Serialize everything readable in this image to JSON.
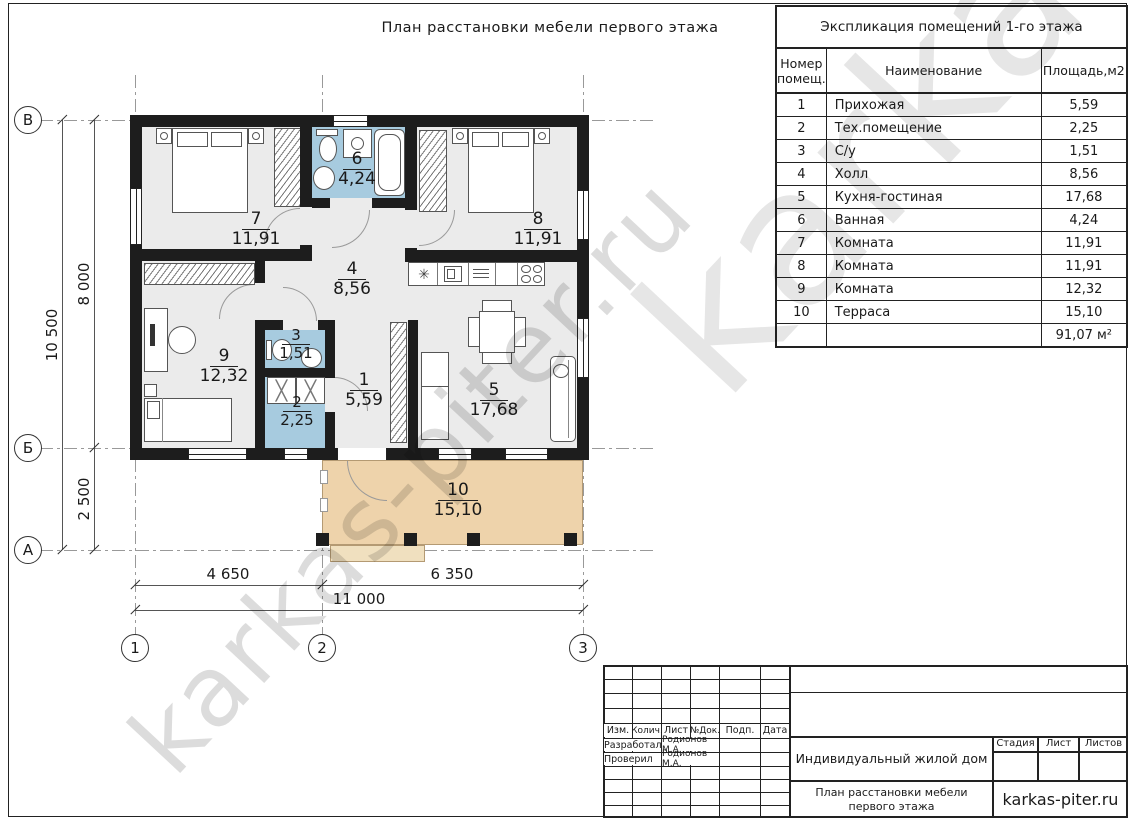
{
  "sheet": {
    "title": "План расстановки мебели первого этажа"
  },
  "watermark": {
    "text": "karkas-piter.ru"
  },
  "icons": {
    "counter_sink": "✳",
    "equipment_cross": "╳"
  },
  "colors": {
    "wall": "#1d1d1d",
    "room_fill": "#ebebeb",
    "wet_room_fill": "#a7cbdf",
    "terrace_fill": "#eed3ab"
  },
  "schedule": {
    "title": "Экспликация помещений 1-го этажа",
    "col_num": "Номер помещ.",
    "col_name": "Наименование",
    "col_area": "Площадь,м2",
    "rows": [
      {
        "num": "1",
        "name": "Прихожая",
        "area": "5,59"
      },
      {
        "num": "2",
        "name": "Тех.помещение",
        "area": "2,25"
      },
      {
        "num": "3",
        "name": "С/у",
        "area": "1,51"
      },
      {
        "num": "4",
        "name": "Холл",
        "area": "8,56"
      },
      {
        "num": "5",
        "name": "Кухня-гостиная",
        "area": "17,68"
      },
      {
        "num": "6",
        "name": "Ванная",
        "area": "4,24"
      },
      {
        "num": "7",
        "name": "Комната",
        "area": "11,91"
      },
      {
        "num": "8",
        "name": "Комната",
        "area": "11,91"
      },
      {
        "num": "9",
        "name": "Комната",
        "area": "12,32"
      },
      {
        "num": "10",
        "name": "Терраса",
        "area": "15,10"
      }
    ],
    "total": "91,07 м²"
  },
  "plan": {
    "rooms": [
      {
        "num": "1",
        "area": "5,59"
      },
      {
        "num": "2",
        "area": "2,25"
      },
      {
        "num": "3",
        "area": "1,51"
      },
      {
        "num": "4",
        "area": "8,56"
      },
      {
        "num": "5",
        "area": "17,68"
      },
      {
        "num": "6",
        "area": "4,24"
      },
      {
        "num": "7",
        "area": "11,91"
      },
      {
        "num": "8",
        "area": "11,91"
      },
      {
        "num": "9",
        "area": "12,32"
      },
      {
        "num": "10",
        "area": "15,10"
      }
    ],
    "axes": {
      "row_top": "В",
      "row_mid": "Б",
      "row_bottom": "А",
      "col_left": "1",
      "col_mid": "2",
      "col_right": "3"
    },
    "dims": {
      "left_total": "10 500",
      "left_upper": "8 000",
      "left_lower": "2 500",
      "bottom_left": "4 650",
      "bottom_right": "6 350",
      "bottom_total": "11 000"
    }
  },
  "titleblock": {
    "cols": {
      "izm": "Изм.",
      "kol": "Колич.",
      "list": "Лист",
      "doc": "№Док.",
      "podp": "Подп.",
      "data": "Дата"
    },
    "row1": {
      "label": "Разработал",
      "value": "Родионов М.А."
    },
    "row2": {
      "label": "Проверил",
      "value": "Родионов М.А."
    },
    "project": "Индивидуальный жилой дом",
    "stage": {
      "stadia": "Стадия",
      "list": "Лист",
      "listov": "Листов"
    },
    "doc_title": "План расстановки мебели первого этажа",
    "brand": "karkas-piter.ru"
  }
}
